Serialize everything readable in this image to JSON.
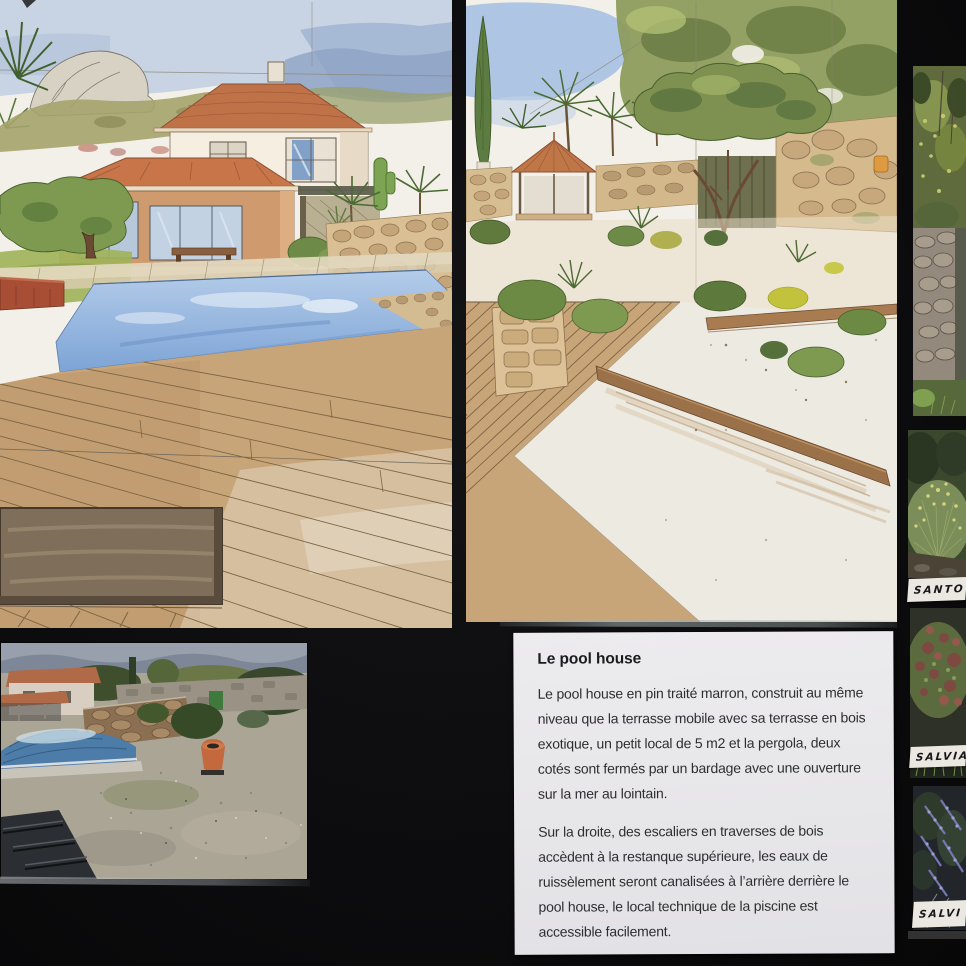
{
  "text_panel": {
    "title": "Le pool house",
    "paragraph1": "Le pool house en pin traité marron, construit au même niveau que la terrasse mobile avec sa terrasse en bois exotique, un petit local de 5 m2 et la pergola, deux cotés sont fermés par un bardage avec une ouverture sur la mer au lointain.",
    "paragraph2": "Sur la droite, des escaliers en traverses de bois accèdent à la restanque supérieure, les eaux de ruissèlement seront canalisées à l’arrière derrière le pool house, le local technique de la piscine est accessible facilement."
  },
  "plant_photos": {
    "labels": [
      "SANTO",
      "SALVIA",
      "SALVI"
    ]
  },
  "palette": {
    "board_black": "#0c0c0e",
    "paper": "#f3f0e9",
    "terracotta_roof": "#c0734a",
    "pool_water": "#86abd9",
    "deck_wood": "#c8a578",
    "stone_wall": "#d5ba8e",
    "foliage_olive": "#7e9150",
    "card_paper": "#e9e8ea"
  }
}
